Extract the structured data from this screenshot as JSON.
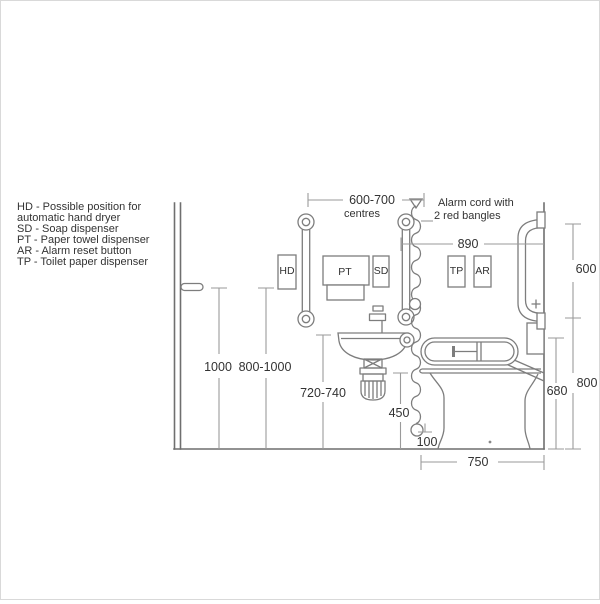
{
  "legend": {
    "lines": [
      "HD - Possible position for",
      "automatic hand dryer",
      "SD - Soap dispenser",
      "PT - Paper towel dispenser",
      "AR - Alarm reset button",
      "TP - Toilet paper dispenser"
    ]
  },
  "annotations": {
    "alarm_line1": "Alarm cord with",
    "alarm_line2": "2 red bangles"
  },
  "fixture_labels": {
    "hd": "HD",
    "pt": "PT",
    "sd": "SD",
    "tp": "TP",
    "ar": "AR"
  },
  "dimensions": {
    "rail_centres": "600-700",
    "rail_centres_unit": "centres",
    "cord_to_wall": "890",
    "wall_rail_length": "600",
    "wall_rail_bottom_height": "800",
    "dropdown_rail_height": "680",
    "handle_height": "1000",
    "dispenser_height": "800-1000",
    "basin_height": "720-740",
    "lower_cord_height": "450",
    "bangle_floor_clearance": "100",
    "wc_depth": "750"
  },
  "colors": {
    "drawing_line": "#7d7d7d",
    "dimension_line": "#9a9a9a",
    "text": "#333333",
    "background": "#ffffff"
  }
}
